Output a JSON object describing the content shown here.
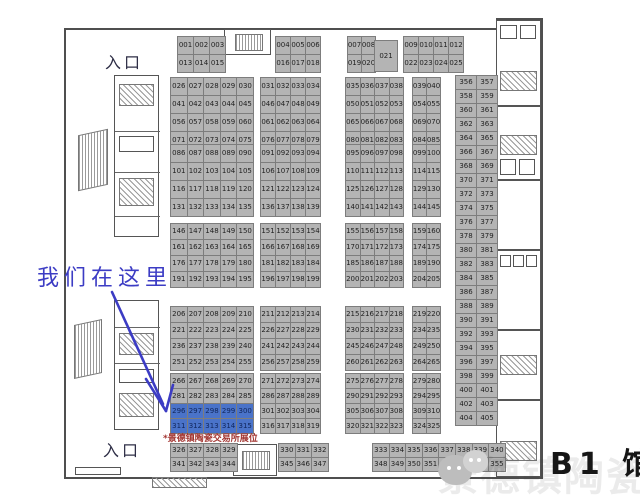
{
  "annotations": {
    "entrance_top": "入口",
    "entrance_bottom": "入口",
    "we_are_here": "我们在这里",
    "booth_note": "*景德镇陶瓷交易所展位",
    "hall_label": "B1 馆",
    "watermark": "景德镇陶瓷文化"
  },
  "colors": {
    "booth_fill": "#b4b4b4",
    "booth_border": "#7d7d7d",
    "highlight_fill": "#4a73c9",
    "annotation_blue": "#3c3cc4",
    "note_red": "#a23430",
    "wall": "#4f4f4f"
  },
  "floorplan": {
    "highlighted": [
      "296",
      "297",
      "298",
      "299",
      "300",
      "311",
      "312",
      "313",
      "314",
      "315"
    ],
    "groups": [
      {
        "id": "top-1",
        "x": 177,
        "y": 36,
        "cols": 3,
        "cw": 15,
        "ch": 17,
        "labels": [
          "001",
          "002",
          "003",
          "013",
          "014",
          "015"
        ]
      },
      {
        "id": "top-2",
        "x": 275,
        "y": 36,
        "cols": 3,
        "cw": 14,
        "ch": 17,
        "labels": [
          "004",
          "005",
          "006",
          "016",
          "017",
          "018"
        ]
      },
      {
        "id": "top-3",
        "x": 347,
        "y": 36,
        "cols": 2,
        "cw": 13,
        "ch": 17,
        "labels": [
          "007",
          "008",
          "019",
          "020"
        ]
      },
      {
        "id": "top-021",
        "x": 374,
        "y": 40,
        "cols": 1,
        "cw": 22,
        "ch": 30,
        "labels": [
          "021"
        ]
      },
      {
        "id": "top-4",
        "x": 403,
        "y": 36,
        "cols": 4,
        "cw": 14,
        "ch": 17,
        "labels": [
          "009",
          "010",
          "011",
          "012",
          "022",
          "023",
          "024",
          "025"
        ]
      },
      {
        "id": "b2-1",
        "x": 170,
        "y": 77,
        "cols": 5,
        "cw": 15.6,
        "ch": 17,
        "labels": [
          "026",
          "027",
          "028",
          "029",
          "030",
          "041",
          "042",
          "043",
          "044",
          "045",
          "056",
          "057",
          "058",
          "059",
          "060",
          "071",
          "072",
          "073",
          "074",
          "075"
        ]
      },
      {
        "id": "b2-2",
        "x": 260,
        "y": 77,
        "cols": 4,
        "cw": 14,
        "ch": 17,
        "labels": [
          "031",
          "032",
          "033",
          "034",
          "046",
          "047",
          "048",
          "049",
          "061",
          "062",
          "063",
          "064",
          "076",
          "077",
          "078",
          "079"
        ]
      },
      {
        "id": "b2-3",
        "x": 345,
        "y": 77,
        "cols": 4,
        "cw": 13.5,
        "ch": 17,
        "labels": [
          "035",
          "036",
          "037",
          "038",
          "050",
          "051",
          "052",
          "053",
          "065",
          "066",
          "067",
          "068",
          "080",
          "081",
          "082",
          "083"
        ]
      },
      {
        "id": "b2-4",
        "x": 412,
        "y": 77,
        "cols": 2,
        "cw": 13,
        "ch": 17,
        "labels": [
          "039",
          "040",
          "054",
          "055",
          "069",
          "070",
          "084",
          "085"
        ]
      },
      {
        "id": "b3-1",
        "x": 170,
        "y": 144,
        "cols": 5,
        "cw": 15.6,
        "ch": 17,
        "labels": [
          "086",
          "087",
          "088",
          "089",
          "090",
          "101",
          "102",
          "103",
          "104",
          "105",
          "116",
          "117",
          "118",
          "119",
          "120",
          "131",
          "132",
          "133",
          "134",
          "135"
        ]
      },
      {
        "id": "b3-2",
        "x": 260,
        "y": 144,
        "cols": 4,
        "cw": 14,
        "ch": 17,
        "labels": [
          "091",
          "092",
          "093",
          "094",
          "106",
          "107",
          "108",
          "109",
          "121",
          "122",
          "123",
          "124",
          "136",
          "137",
          "138",
          "139"
        ]
      },
      {
        "id": "b3-3",
        "x": 345,
        "y": 144,
        "cols": 4,
        "cw": 13.5,
        "ch": 17,
        "labels": [
          "095",
          "096",
          "097",
          "098",
          "110",
          "111",
          "112",
          "113",
          "125",
          "126",
          "127",
          "128",
          "140",
          "141",
          "142",
          "143"
        ]
      },
      {
        "id": "b3-4",
        "x": 412,
        "y": 144,
        "cols": 2,
        "cw": 13,
        "ch": 17,
        "labels": [
          "099",
          "100",
          "114",
          "115",
          "129",
          "130",
          "144",
          "145"
        ]
      },
      {
        "id": "b4-1",
        "x": 170,
        "y": 223,
        "cols": 5,
        "cw": 15.6,
        "ch": 15,
        "labels": [
          "146",
          "147",
          "148",
          "149",
          "150",
          "161",
          "162",
          "163",
          "164",
          "165",
          "176",
          "177",
          "178",
          "179",
          "180",
          "191",
          "192",
          "193",
          "194",
          "195"
        ]
      },
      {
        "id": "b4-2",
        "x": 260,
        "y": 223,
        "cols": 4,
        "cw": 14,
        "ch": 15,
        "labels": [
          "151",
          "152",
          "153",
          "154",
          "166",
          "167",
          "168",
          "169",
          "181",
          "182",
          "183",
          "184",
          "196",
          "197",
          "198",
          "199"
        ]
      },
      {
        "id": "b4-3",
        "x": 345,
        "y": 223,
        "cols": 4,
        "cw": 13.5,
        "ch": 15,
        "labels": [
          "155",
          "156",
          "157",
          "158",
          "170",
          "171",
          "172",
          "173",
          "185",
          "186",
          "187",
          "188",
          "200",
          "201",
          "202",
          "203"
        ]
      },
      {
        "id": "b4-4",
        "x": 412,
        "y": 223,
        "cols": 2,
        "cw": 13,
        "ch": 15,
        "labels": [
          "159",
          "160",
          "174",
          "175",
          "189",
          "190",
          "204",
          "205"
        ]
      },
      {
        "id": "b5-1",
        "x": 170,
        "y": 306,
        "cols": 5,
        "cw": 15.6,
        "ch": 15,
        "labels": [
          "206",
          "207",
          "208",
          "209",
          "210",
          "221",
          "222",
          "223",
          "224",
          "225",
          "236",
          "237",
          "238",
          "239",
          "240",
          "251",
          "252",
          "253",
          "254",
          "255"
        ]
      },
      {
        "id": "b5-2",
        "x": 260,
        "y": 306,
        "cols": 4,
        "cw": 14,
        "ch": 15,
        "labels": [
          "211",
          "212",
          "213",
          "214",
          "226",
          "227",
          "228",
          "229",
          "241",
          "242",
          "243",
          "244",
          "256",
          "257",
          "258",
          "259"
        ]
      },
      {
        "id": "b5-3",
        "x": 345,
        "y": 306,
        "cols": 4,
        "cw": 13.5,
        "ch": 15,
        "labels": [
          "215",
          "216",
          "217",
          "218",
          "230",
          "231",
          "232",
          "233",
          "245",
          "246",
          "247",
          "248",
          "260",
          "261",
          "262",
          "263"
        ]
      },
      {
        "id": "b5-4",
        "x": 412,
        "y": 306,
        "cols": 2,
        "cw": 13,
        "ch": 15,
        "labels": [
          "219",
          "220",
          "234",
          "235",
          "249",
          "250",
          "264",
          "265"
        ]
      },
      {
        "id": "b6-1",
        "x": 170,
        "y": 373,
        "cols": 5,
        "cw": 15.6,
        "ch": 14,
        "labels": [
          "266",
          "267",
          "268",
          "269",
          "270",
          "281",
          "282",
          "283",
          "284",
          "285",
          "296",
          "297",
          "298",
          "299",
          "300",
          "311",
          "312",
          "313",
          "314",
          "315"
        ]
      },
      {
        "id": "b6-2",
        "x": 260,
        "y": 373,
        "cols": 4,
        "cw": 14,
        "ch": 14,
        "labels": [
          "271",
          "272",
          "273",
          "274",
          "286",
          "287",
          "288",
          "289",
          "301",
          "302",
          "303",
          "304",
          "316",
          "317",
          "318",
          "319"
        ]
      },
      {
        "id": "b6-3",
        "x": 345,
        "y": 373,
        "cols": 4,
        "cw": 13.5,
        "ch": 14,
        "labels": [
          "275",
          "276",
          "277",
          "278",
          "290",
          "291",
          "292",
          "293",
          "305",
          "306",
          "307",
          "308",
          "320",
          "321",
          "322",
          "323"
        ]
      },
      {
        "id": "b6-4",
        "x": 412,
        "y": 373,
        "cols": 2,
        "cw": 13,
        "ch": 14,
        "labels": [
          "279",
          "280",
          "294",
          "295",
          "309",
          "310",
          "324",
          "325"
        ]
      },
      {
        "id": "bot-1",
        "x": 170,
        "y": 443,
        "cols": 4,
        "cw": 15.7,
        "ch": 13,
        "labels": [
          "326",
          "327",
          "328",
          "329",
          "341",
          "342",
          "343",
          "344"
        ]
      },
      {
        "id": "bot-2",
        "x": 278,
        "y": 443,
        "cols": 3,
        "cw": 15.5,
        "ch": 13,
        "labels": [
          "330",
          "331",
          "332",
          "345",
          "346",
          "347"
        ]
      },
      {
        "id": "bot-3",
        "x": 372,
        "y": 443,
        "cols": 8,
        "cw": 15.6,
        "ch": 13,
        "labels": [
          "333",
          "334",
          "335",
          "336",
          "337",
          "338",
          "339",
          "340",
          "348",
          "349",
          "350",
          "351",
          "352",
          "353",
          "354",
          "355"
        ]
      },
      {
        "id": "right-col",
        "x": 455,
        "y": 75,
        "cols": 2,
        "cw": 20,
        "ch": 13,
        "labels": [
          "356",
          "357",
          "358",
          "359",
          "360",
          "361",
          "362",
          "363",
          "364",
          "365",
          "366",
          "367",
          "368",
          "369",
          "370",
          "371",
          "372",
          "373",
          "374",
          "375",
          "376",
          "377",
          "378",
          "379",
          "380",
          "381",
          "382",
          "383",
          "384",
          "385",
          "386",
          "387",
          "388",
          "389",
          "390",
          "391",
          "392",
          "393",
          "394",
          "395",
          "396",
          "397",
          "398",
          "399",
          "400",
          "401",
          "402",
          "403",
          "404",
          "405"
        ]
      }
    ]
  }
}
